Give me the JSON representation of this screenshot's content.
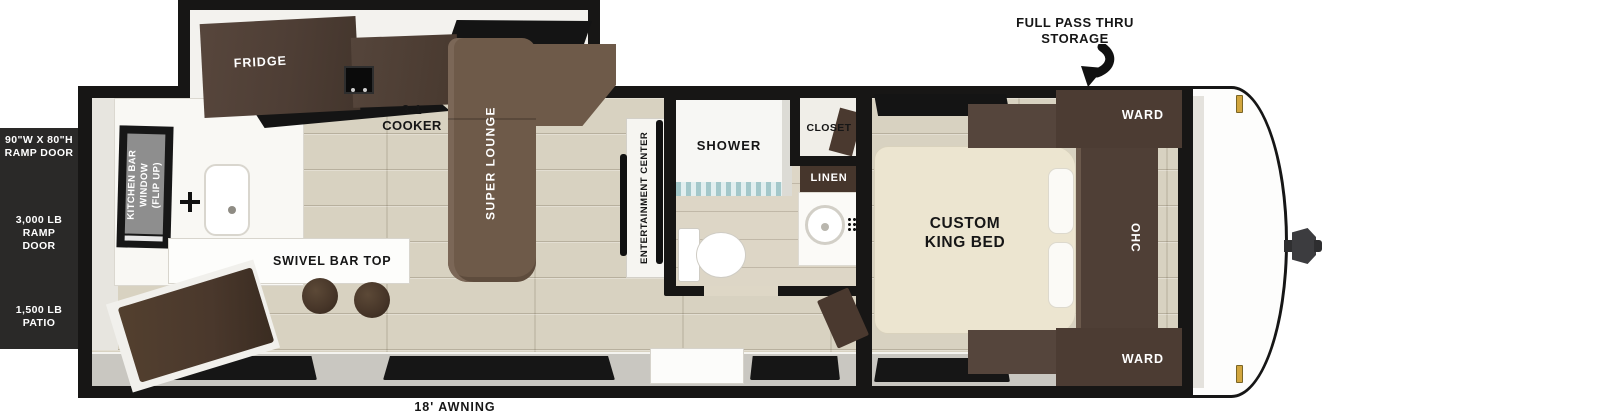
{
  "panel": {
    "ramp_door_size": "90\"W X 80\"H\nRAMP DOOR",
    "ramp_door_capacity": "3,000 LB RAMP\nDOOR",
    "patio_capacity": "1,500 LB\nPATIO"
  },
  "exterior": {
    "pass_thru": "FULL PASS THRU\nSTORAGE",
    "awning": "18' AWNING"
  },
  "kitchen": {
    "fridge": "FRIDGE",
    "cooker": "3-1\nCOOKER",
    "bar_window": "KITCHEN BAR\nWINDOW\n(FLIP UP)",
    "bar_top": "SWIVEL BAR TOP"
  },
  "living": {
    "lounge": "SUPER LOUNGE",
    "entertainment_center": "ENTERTAINMENT CENTER"
  },
  "bathroom": {
    "shower": "SHOWER",
    "closet": "CLOSET",
    "linen": "LINEN"
  },
  "bedroom": {
    "bed": "CUSTOM\nKING BED",
    "ward_front": "WARD",
    "ward_rear": "WARD",
    "ohc": "OHC"
  },
  "colors": {
    "wall": "#171615",
    "spec_panel_bg": "#2a2928",
    "floor": "#d8d2c1",
    "cabinet_dark": "#4c3c33",
    "lounge_brown": "#6e5a49",
    "bed_cream": "#ece5d0",
    "hinge_gold": "#d2a63e"
  }
}
